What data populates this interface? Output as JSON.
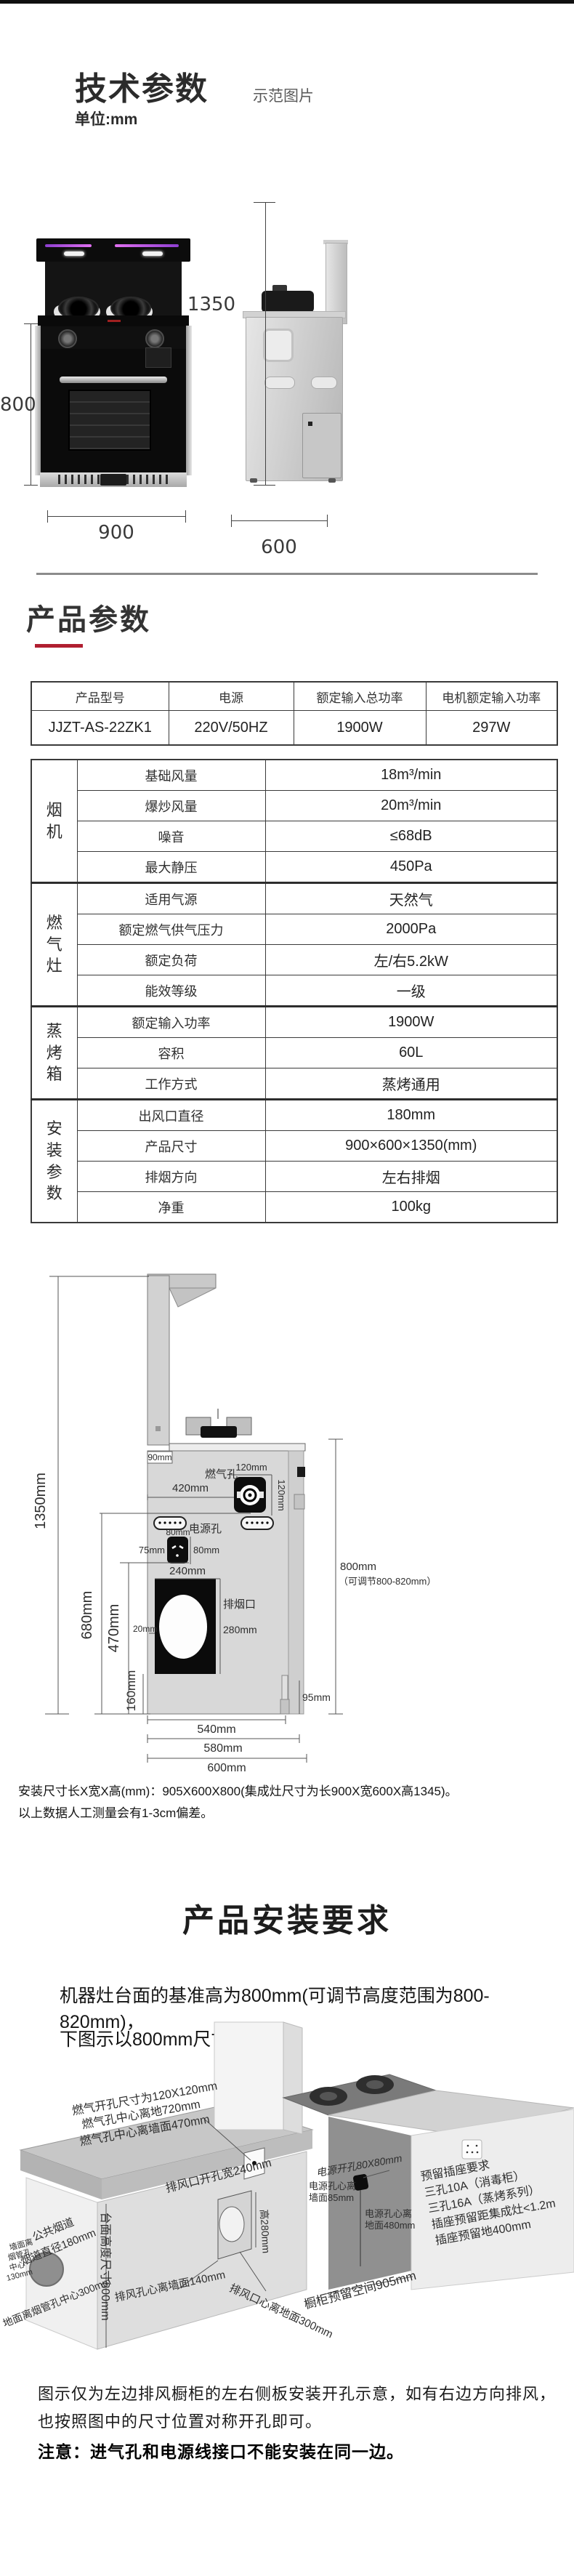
{
  "header": {
    "title": "技术参数",
    "subtitle": "示范图片",
    "unit_note": "单位:mm"
  },
  "product_views": {
    "dim_height_total": "1350",
    "dim_height_body": "800",
    "dim_width_front": "900",
    "dim_width_side": "600"
  },
  "section_params": {
    "title": "产品参数"
  },
  "model_table": {
    "headers": [
      "产品型号",
      "电源",
      "额定输入总功率",
      "电机额定输入功率"
    ],
    "values": [
      "JJZT-AS-22ZK1",
      "220V/50HZ",
      "1900W",
      "297W"
    ]
  },
  "spec_table": {
    "groups": [
      {
        "name": "烟机",
        "rows": [
          {
            "label": "基础风量",
            "value": "18m³/min"
          },
          {
            "label": "爆炒风量",
            "value": "20m³/min"
          },
          {
            "label": "噪音",
            "value": "≤68dB"
          },
          {
            "label": "最大静压",
            "value": "450Pa"
          }
        ]
      },
      {
        "name": "燃气灶",
        "rows": [
          {
            "label": "适用气源",
            "value": "天然气"
          },
          {
            "label": "额定燃气供气压力",
            "value": "2000Pa"
          },
          {
            "label": "额定负荷",
            "value": "左/右5.2kW"
          },
          {
            "label": "能效等级",
            "value": "一级"
          }
        ]
      },
      {
        "name": "蒸烤箱",
        "rows": [
          {
            "label": "额定输入功率",
            "value": "1900W"
          },
          {
            "label": "容积",
            "value": "60L"
          },
          {
            "label": "工作方式",
            "value": "蒸烤通用"
          }
        ]
      },
      {
        "name": "安装参数",
        "rows": [
          {
            "label": "出风口直径",
            "value": "180mm"
          },
          {
            "label": "产品尺寸",
            "value": "900×600×1350(mm)"
          },
          {
            "label": "排烟方向",
            "value": "左右排烟"
          },
          {
            "label": "净重",
            "value": "100kg"
          }
        ]
      }
    ]
  },
  "install_diagram": {
    "dim_1350": "1350mm",
    "dim_90": "90mm",
    "label_gas_hole": "燃气孔",
    "dim_120_h": "120mm",
    "dim_120_v": "120mm",
    "dim_420": "420mm",
    "label_power_hole": "电源孔",
    "dim_80_top": "80mm",
    "dim_75": "75mm",
    "dim_80_right": "80mm",
    "dim_240": "240mm",
    "label_exhaust": "排烟口",
    "dim_280": "280mm",
    "dim_20": "20mm",
    "dim_680": "680mm",
    "dim_470": "470mm",
    "dim_160": "160mm",
    "dim_800": "800mm",
    "dim_800_range": "（可调节800-820mm）",
    "dim_95": "95mm",
    "dim_540": "540mm",
    "dim_580": "580mm",
    "dim_600": "600mm",
    "note1": "安装尺寸长X宽X高(mm)：905X600X800(集成灶尺寸为长900X宽600X高1345)。",
    "note2": "以上数据人工测量会有1-3cm偏差。"
  },
  "section_install": {
    "title": "产品安装要求",
    "desc1": "机器灶台面的基准高为800mm(可调节高度范围为800-820mm)，",
    "desc2": "下图示以800mm尺寸示范。"
  },
  "diagram_3d": {
    "gas_note1": "燃气开孔尺寸为120X120mm",
    "gas_note2": "燃气孔中心离地720mm",
    "gas_note3": "燃气孔中心离墙面470mm",
    "vent_width": "排风口开孔宽240mm",
    "vent_height": "高280mm",
    "counter_height": "台面高度尺寸800mm",
    "duct_name": "公共烟道",
    "duct_dia": "烟道直径180mm",
    "wall_duct_l1": "墙面离",
    "wall_duct_l2": "烟管孔",
    "wall_duct_l3": "中心",
    "wall_duct_l4": "130mm",
    "floor_duct": "地面离烟管孔中心300mm",
    "vent_wall": "排风孔心离墙面140mm",
    "vent_floor": "排风口心离地面300mm",
    "power_hole": "电源开孔80X80mm",
    "power_wall_l1": "电源孔心离",
    "power_wall_l2": "墙面85mm",
    "power_floor_l1": "电源孔心离",
    "power_floor_l2": "地面480mm",
    "socket_l1": "预留插座要求",
    "socket_l2": "三孔10A（消毒柜）",
    "socket_l3": "三孔16A（蒸烤系列）",
    "socket_l4": "插座预留距集成灶<1.2m",
    "socket_l5": "插座预留地400mm",
    "cabinet_space": "橱柜预留空间905mm"
  },
  "footer": {
    "note1": "图示仅为左边排风橱柜的左右侧板安装开孔示意，如有右边方向排风，",
    "note2": "也按照图中的尺寸位置对称开孔即可。",
    "note3": "注意：进气孔和电源线接口不能安装在同一边。"
  }
}
